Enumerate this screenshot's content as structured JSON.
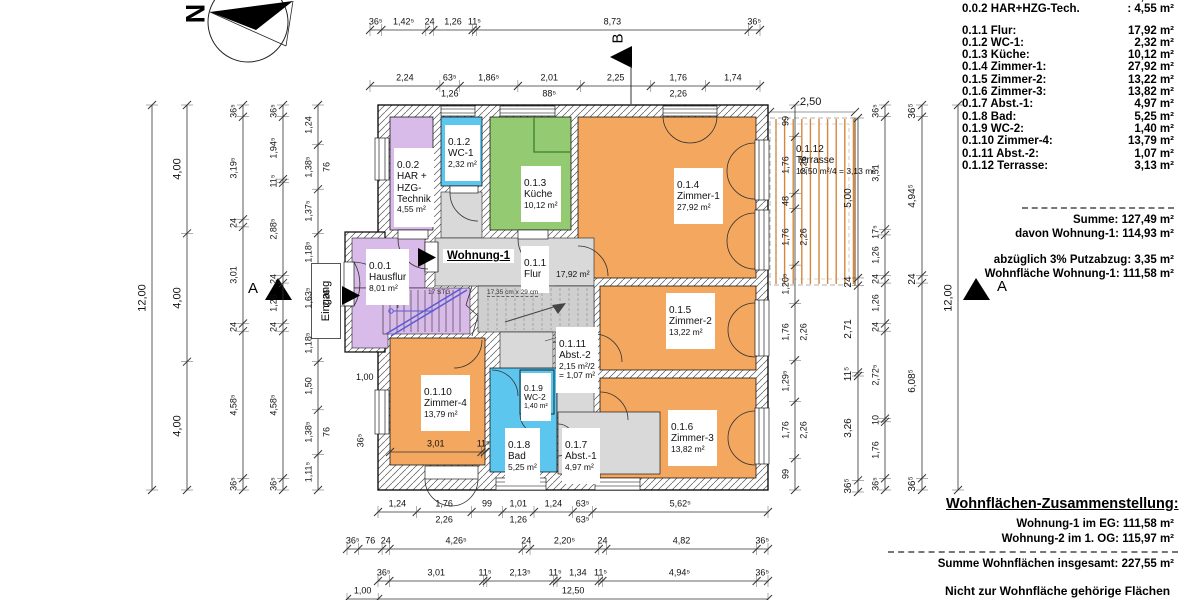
{
  "north_label": "N",
  "section_markers": {
    "a_left": "A",
    "a_right": "A",
    "b_top": "B"
  },
  "plan": {
    "apartment_label": "Wohnung-1",
    "entrance_label": "Eingang",
    "stair_note_1": "17 STG",
    "stair_note_2": "17,35 cm x 29 cm",
    "rooms": [
      {
        "id": "0.0.1",
        "name": "Hausflur",
        "area": "8,01 m²"
      },
      {
        "id": "0.0.2",
        "name": "HAR +\nHZG-\nTechnik",
        "area": "4,55 m²"
      },
      {
        "id": "0.1.1",
        "name": "Flur",
        "area": "17,92 m²"
      },
      {
        "id": "0.1.2",
        "name": "WC-1",
        "area": "2,32 m²"
      },
      {
        "id": "0.1.3",
        "name": "Küche",
        "area": "10,12 m²"
      },
      {
        "id": "0.1.4",
        "name": "Zimmer-1",
        "area": "27,92 m²"
      },
      {
        "id": "0.1.5",
        "name": "Zimmer-2",
        "area": "13,22 m²"
      },
      {
        "id": "0.1.6",
        "name": "Zimmer-3",
        "area": "13,82 m²"
      },
      {
        "id": "0.1.7",
        "name": "Abst.-1",
        "area": "4,97 m²"
      },
      {
        "id": "0.1.8",
        "name": "Bad",
        "area": "5,25 m²"
      },
      {
        "id": "0.1.9",
        "name": "WC-2",
        "area": "1,40 m²"
      },
      {
        "id": "0.1.10",
        "name": "Zimmer-4",
        "area": "13,79 m²"
      },
      {
        "id": "0.1.11",
        "name": "Abst.-2",
        "area": "2,15 m²/2\n= 1,07 m²"
      },
      {
        "id": "0.1.12",
        "name": "Terrasse",
        "area": "12,50 m²/4 = 3,13 m²"
      }
    ]
  },
  "dimensions": {
    "top1": [
      "36⁵",
      "1,42⁵",
      "24",
      "1,26",
      "11⁵",
      "8,73",
      "36⁵"
    ],
    "top2": [
      "2,24",
      "63⁵\n1,26",
      "1,86⁵",
      "2,01\n88⁵",
      "2,25",
      "1,76\n2,26",
      "1,74"
    ],
    "bottom1": [
      "1,24",
      "1,76\n2,26",
      "99",
      "1,01\n1,26",
      "1,24",
      "63⁵\n63⁵",
      "5,62⁵"
    ],
    "bottom2": [
      "36⁵",
      "76",
      "24",
      "4,26⁵",
      "24",
      "2,20⁵",
      "24",
      "4,82",
      "36⁵"
    ],
    "bottom3": [
      "36⁵",
      "3,01",
      "11⁵",
      "2,13⁵",
      "11⁵",
      "1,34",
      "11⁵",
      "4,94⁵",
      "36⁵"
    ],
    "bottom4": [
      "1,00",
      "12,50"
    ],
    "left1": [
      "12,00"
    ],
    "left2": [
      "4,00",
      "4,00",
      "4,00"
    ],
    "left3": [
      "36⁵",
      "3,19⁵",
      "24",
      "3,01",
      "24",
      "4,58⁵",
      "36⁵"
    ],
    "left4": [
      "36⁵",
      "1,94⁵",
      "11⁵",
      "2,88⁵",
      "24",
      "1,26",
      "24",
      "4,58⁵",
      "36⁵"
    ],
    "left5": [
      "1,24",
      "1,38⁵\n76",
      "1,37⁵",
      "1,18⁵",
      "1,63⁵\n2,26",
      "1,18⁵",
      "1,50",
      "1,38⁵\n76",
      "1,11⁵"
    ],
    "right1": [
      "99",
      "1,76\n2,26",
      "48",
      "1,76\n2,26",
      "1,20⁵",
      "1,76\n2,26",
      "1,29⁵",
      "1,76\n2,26",
      "99"
    ],
    "right2": [
      "5,00",
      "24",
      "2,71",
      "11⁵",
      "3,26",
      "36⁵"
    ],
    "right3": [
      "36⁵",
      "3,51",
      "17⁵",
      "1,26",
      "24",
      "1,26",
      "24",
      "2,72⁵",
      "10",
      "1,76",
      "36⁵"
    ],
    "right4": [
      "36⁵",
      "4,94⁵",
      "24",
      "6,08⁵",
      "36⁵"
    ],
    "right5": [
      "12,00"
    ],
    "zimmer4_inner": [
      "3,01",
      "11⁵"
    ]
  },
  "annotations": {
    "terrace_width": "2,50",
    "vestibule_dim": "1,00",
    "wall_dim": "36⁵"
  },
  "schedule": {
    "rows": [
      {
        "label": "0.0.1 Hausflur:",
        "value": "8,01 m²"
      },
      {
        "label": "0.0.2 HAR+HZG-Tech.",
        "value": ": 4,55 m²"
      },
      {
        "label": "0.1.1 Flur:",
        "value": "17,92 m²"
      },
      {
        "label": "0.1.2 WC-1:",
        "value": "2,32 m²"
      },
      {
        "label": "0.1.3 Küche:",
        "value": "10,12 m²"
      },
      {
        "label": "0.1.4 Zimmer-1:",
        "value": "27,92 m²"
      },
      {
        "label": "0.1.5 Zimmer-2:",
        "value": "13,22 m²"
      },
      {
        "label": "0.1.6 Zimmer-3:",
        "value": "13,82 m²"
      },
      {
        "label": "0.1.7 Abst.-1:",
        "value": "4,97 m²"
      },
      {
        "label": "0.1.8 Bad:",
        "value": "5,25 m²"
      },
      {
        "label": "0.1.9 WC-2:",
        "value": "1,40 m²"
      },
      {
        "label": "0.1.10 Zimmer-4:",
        "value": "13,79 m²"
      },
      {
        "label": "0.1.11 Abst.-2:",
        "value": "1,07 m²"
      },
      {
        "label": "0.1.12 Terrasse:",
        "value": "3,13 m²"
      }
    ]
  },
  "summary": {
    "summe": "Summe:  127,49 m²",
    "davon": "davon Wohnung-1: 114,93 m²",
    "abzug": "abzüglich 3% Putzabzug: 3,35 m²",
    "wohnflaeche": "Wohnfläche Wohnung-1: 111,58 m²"
  },
  "totals": {
    "heading": "Wohnflächen-Zusammenstellung:",
    "rows": [
      {
        "label": "Wohnung-1 im EG:",
        "value": "111,58 m²"
      },
      {
        "label": "Wohnung-2 im 1. OG:",
        "value": "115,97 m²"
      }
    ],
    "sum_line": "Summe Wohnflächen insgesamt: 227,55 m²",
    "footnote": "Nicht zur Wohnfläche gehörige Flächen"
  },
  "colors": {
    "room_orange": "#f4a75e",
    "room_green": "#94ca72",
    "room_purple": "#d9bbe9",
    "room_blue": "#5cc6ee",
    "room_gray": "#d9d9d9",
    "stair_gray": "#cfcfcf",
    "terrace_stripe": "#d4873a",
    "stair_blue": "#5a5ad2"
  }
}
